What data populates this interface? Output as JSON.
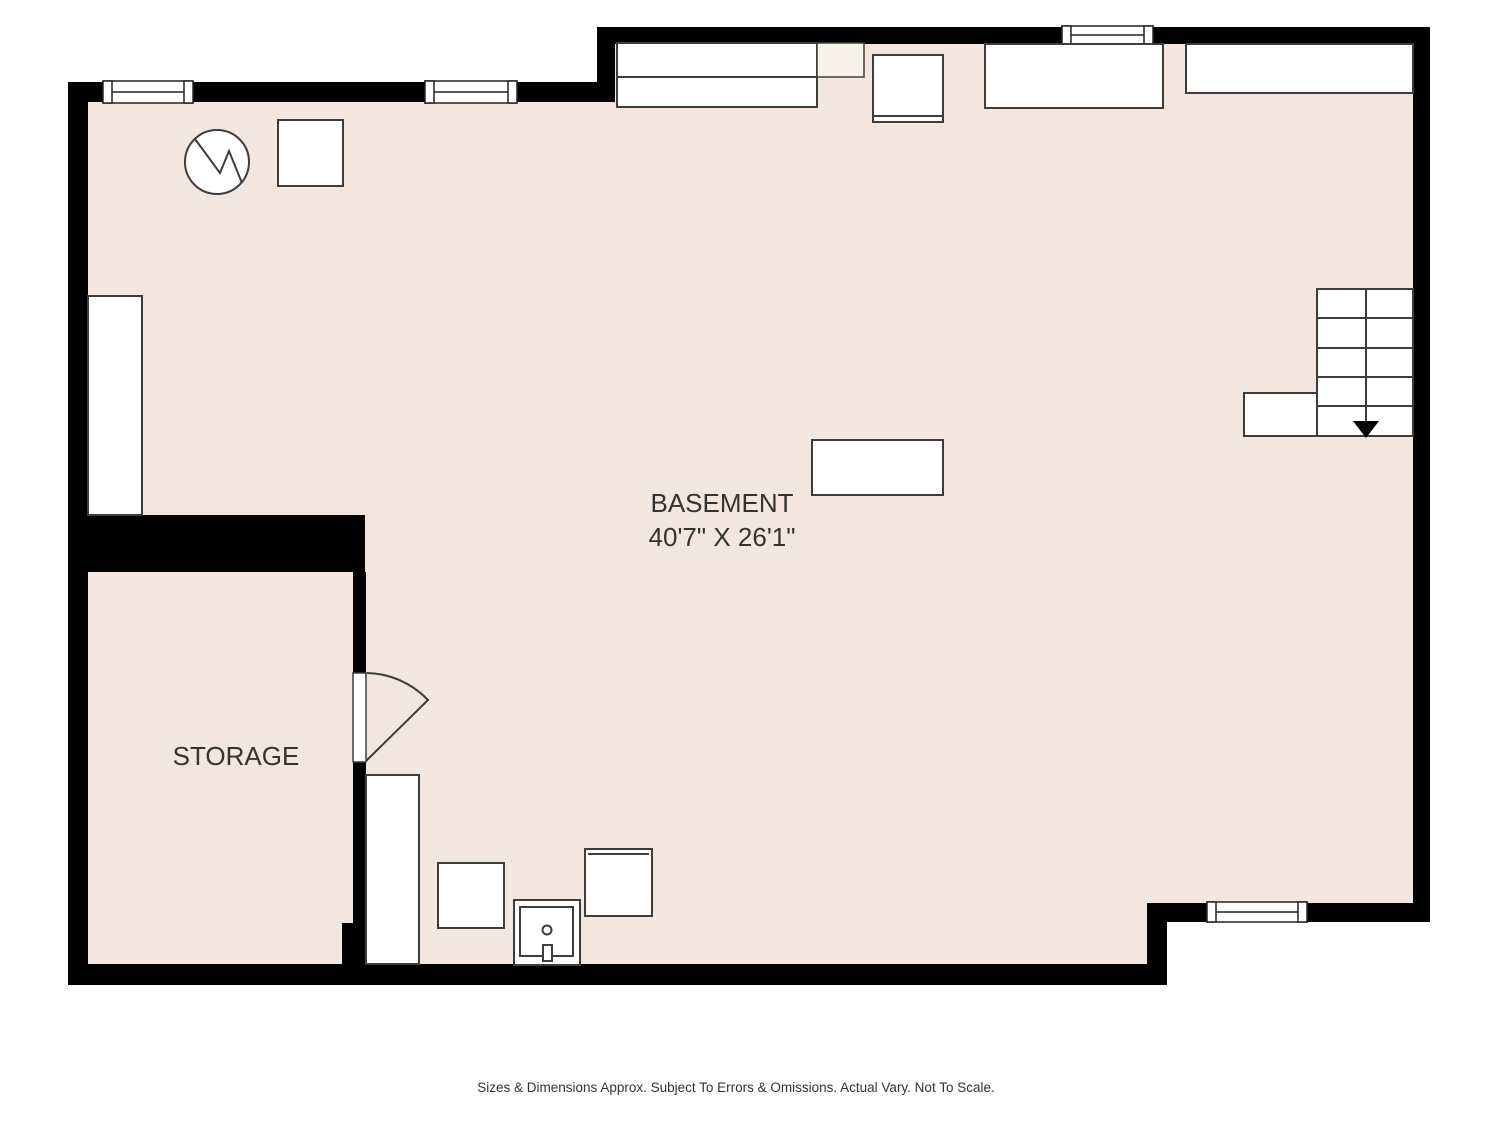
{
  "plan": {
    "title": "Basement floor plan",
    "colors": {
      "floor": "#f2e6df",
      "wall": "#000000",
      "fixture_stroke": "#3d3d3d",
      "fixture_fill": "#ffffff",
      "counter_accent_fill": "#f8f2ec",
      "text": "#333333",
      "background": "#ffffff"
    },
    "symbols": {
      "water_heater": "circle-with-zigzag",
      "stairs_direction": "down-arrow",
      "door": "quarter-arc-swing",
      "window": "double-line-frame",
      "sink": "square-basin-with-drain-and-faucet"
    }
  },
  "rooms": {
    "basement": {
      "name": "BASEMENT",
      "dimensions": "40'7\" X 26'1\""
    },
    "storage": {
      "name": "STORAGE"
    }
  },
  "footer": {
    "disclaimer": "Sizes & Dimensions Approx. Subject To Errors & Omissions. Actual Vary. Not To Scale."
  }
}
